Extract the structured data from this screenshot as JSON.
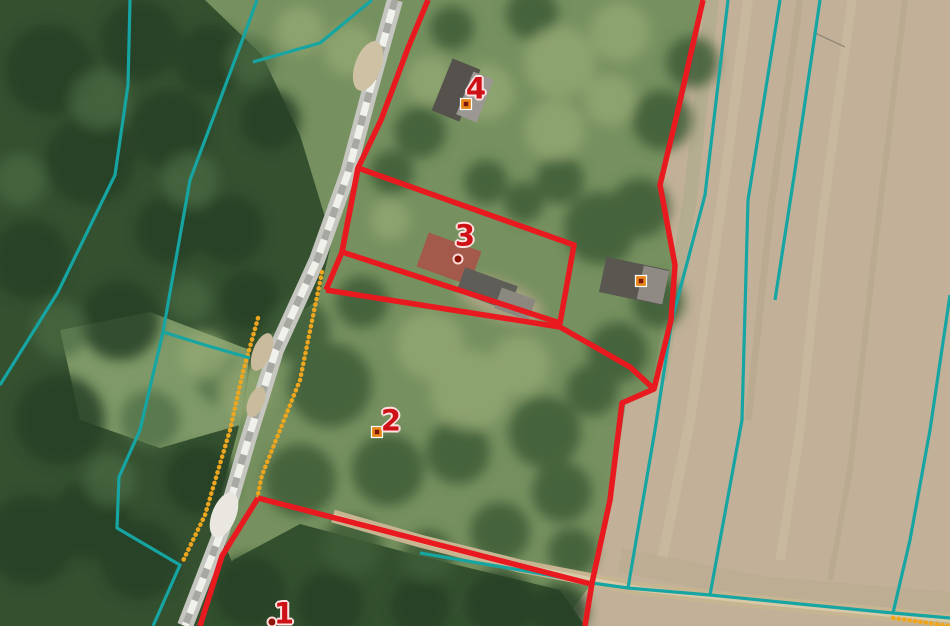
{
  "map": {
    "width": 950,
    "height": 626,
    "colors": {
      "parcel_boundary_red": "#e8191f",
      "cadastral_teal": "#16a5a2",
      "landuse_orange": "#eda61e",
      "label_red": "#ce1117",
      "marker_fill": "#e8861a",
      "marker_core": "#7c1607",
      "marker_dot": "#8c1507"
    },
    "parcel_labels": [
      {
        "text": "1",
        "x": 284,
        "y": 614
      },
      {
        "text": "2",
        "x": 391,
        "y": 421
      },
      {
        "text": "3",
        "x": 465,
        "y": 236
      },
      {
        "text": "4",
        "x": 476,
        "y": 89
      }
    ],
    "markers": [
      {
        "name": "address-marker-4",
        "type": "square",
        "x": 466,
        "y": 104
      },
      {
        "name": "address-marker-3",
        "type": "dot",
        "x": 458,
        "y": 259
      },
      {
        "name": "address-marker-east-building",
        "type": "square",
        "x": 641,
        "y": 281
      },
      {
        "name": "address-marker-2",
        "type": "square",
        "x": 377,
        "y": 432
      },
      {
        "name": "address-marker-1",
        "type": "dot",
        "x": 272,
        "y": 622
      }
    ],
    "layer_styles": {
      "red": {
        "color": "#e8191f",
        "width": 5.5
      },
      "teal": {
        "color": "#16a5a2",
        "width": 3.2
      },
      "orange": {
        "color": "#eda61e",
        "width": 4.4,
        "dash": "0.5 5",
        "cap": "round"
      }
    },
    "features": [
      {
        "name": "landuse-line-road-west",
        "layer": "orange",
        "points": [
          [
            258,
            318
          ],
          [
            243,
            372
          ],
          [
            230,
            430
          ],
          [
            205,
            515
          ],
          [
            182,
            563
          ]
        ]
      },
      {
        "name": "landuse-line-road-east",
        "layer": "orange",
        "points": [
          [
            322,
            272
          ],
          [
            300,
            380
          ],
          [
            280,
            430
          ],
          [
            262,
            475
          ],
          [
            257,
            499
          ]
        ]
      },
      {
        "name": "landuse-line-corner-se",
        "layer": "orange",
        "points": [
          [
            893,
            618
          ],
          [
            950,
            626
          ]
        ]
      },
      {
        "name": "cadastral-line-forest-west",
        "layer": "teal",
        "points": [
          [
            130,
            0
          ],
          [
            128,
            85
          ],
          [
            115,
            175
          ],
          [
            58,
            292
          ],
          [
            0,
            385
          ]
        ]
      },
      {
        "name": "cadastral-line-forest-mid",
        "layer": "teal",
        "points": [
          [
            257,
            0
          ],
          [
            245,
            33
          ],
          [
            190,
            180
          ],
          [
            163,
            332
          ]
        ]
      },
      {
        "name": "cadastral-line-forest-top",
        "layer": "teal",
        "points": [
          [
            372,
            0
          ],
          [
            320,
            43
          ],
          [
            253,
            62
          ]
        ]
      },
      {
        "name": "cadastral-line-branch-to-road",
        "layer": "teal",
        "points": [
          [
            163,
            332
          ],
          [
            205,
            345
          ],
          [
            250,
            358
          ]
        ]
      },
      {
        "name": "cadastral-line-forest-south",
        "layer": "teal",
        "points": [
          [
            163,
            332
          ],
          [
            140,
            430
          ],
          [
            119,
            477
          ],
          [
            117,
            528
          ],
          [
            180,
            565
          ],
          [
            153,
            626
          ]
        ]
      },
      {
        "name": "cadastral-line-field-strip-1",
        "layer": "teal",
        "points": [
          [
            728,
            0
          ],
          [
            705,
            195
          ],
          [
            672,
            320
          ],
          [
            655,
            430
          ],
          [
            628,
            588
          ]
        ]
      },
      {
        "name": "cadastral-line-field-strip-2",
        "layer": "teal",
        "points": [
          [
            780,
            0
          ],
          [
            748,
            200
          ],
          [
            742,
            420
          ],
          [
            710,
            595
          ]
        ]
      },
      {
        "name": "cadastral-line-field-strip-3",
        "layer": "teal",
        "points": [
          [
            820,
            0
          ],
          [
            795,
            170
          ],
          [
            775,
            300
          ]
        ]
      },
      {
        "name": "cadastral-line-field-strip-4",
        "layer": "teal",
        "points": [
          [
            950,
            295
          ],
          [
            930,
            430
          ],
          [
            910,
            540
          ],
          [
            893,
            613
          ]
        ]
      },
      {
        "name": "cadastral-line-farm-track",
        "layer": "teal",
        "points": [
          [
            420,
            553
          ],
          [
            520,
            570
          ],
          [
            592,
            583
          ],
          [
            628,
            588
          ],
          [
            710,
            595
          ],
          [
            800,
            604
          ],
          [
            893,
            613
          ],
          [
            950,
            618
          ]
        ]
      },
      {
        "name": "parcel-boundary-road-north",
        "layer": "red",
        "points": [
          [
            428,
            0
          ],
          [
            408,
            48
          ],
          [
            381,
            120
          ],
          [
            358,
            168
          ]
        ]
      },
      {
        "name": "parcel-3-boundary",
        "layer": "red",
        "closed": true,
        "points": [
          [
            358,
            168
          ],
          [
            574,
            245
          ],
          [
            560,
            323
          ],
          [
            342,
            252
          ]
        ]
      },
      {
        "name": "parcel-boundary-road-mid",
        "layer": "red",
        "points": [
          [
            358,
            168
          ],
          [
            342,
            252
          ],
          [
            326,
            290
          ]
        ]
      },
      {
        "name": "parcel-2-north-boundary",
        "layer": "red",
        "points": [
          [
            326,
            290
          ],
          [
            560,
            327
          ],
          [
            630,
            367
          ],
          [
            654,
            389
          ]
        ]
      },
      {
        "name": "parcel-boundary-east",
        "layer": "red",
        "points": [
          [
            703,
            0
          ],
          [
            678,
            110
          ],
          [
            660,
            185
          ],
          [
            675,
            265
          ],
          [
            671,
            320
          ],
          [
            654,
            389
          ],
          [
            622,
            403
          ],
          [
            610,
            500
          ],
          [
            592,
            583
          ],
          [
            585,
            626
          ]
        ]
      },
      {
        "name": "parcel-2-south-boundary",
        "layer": "red",
        "points": [
          [
            258,
            498
          ],
          [
            420,
            540
          ],
          [
            591,
            584
          ]
        ]
      },
      {
        "name": "parcel-boundary-road-south",
        "layer": "red",
        "points": [
          [
            258,
            498
          ],
          [
            222,
            556
          ],
          [
            200,
            626
          ]
        ]
      }
    ],
    "buildings": [
      {
        "name": "building-4-roof-dark",
        "x": 441,
        "y": 62,
        "w": 30,
        "h": 56,
        "rot": 22,
        "fill": "#55524d"
      },
      {
        "name": "building-4-roof-light",
        "x": 464,
        "y": 74,
        "w": 22,
        "h": 46,
        "rot": 22,
        "fill": "#9b9792"
      },
      {
        "name": "building-3-house-roof",
        "x": 421,
        "y": 241,
        "w": 56,
        "h": 36,
        "rot": 20,
        "fill": "#a35a4b"
      },
      {
        "name": "building-3-shed-roof",
        "x": 459,
        "y": 276,
        "w": 56,
        "h": 26,
        "rot": 20,
        "fill": "#5f5d58"
      },
      {
        "name": "building-3-yard",
        "x": 497,
        "y": 293,
        "w": 36,
        "h": 22,
        "rot": 20,
        "fill": "#8b887f"
      },
      {
        "name": "building-east-roof-dark",
        "x": 602,
        "y": 263,
        "w": 64,
        "h": 36,
        "rot": 12,
        "fill": "#5a5751"
      },
      {
        "name": "building-east-roof-light",
        "x": 640,
        "y": 268,
        "w": 26,
        "h": 34,
        "rot": 12,
        "fill": "#8f8b84"
      }
    ]
  }
}
